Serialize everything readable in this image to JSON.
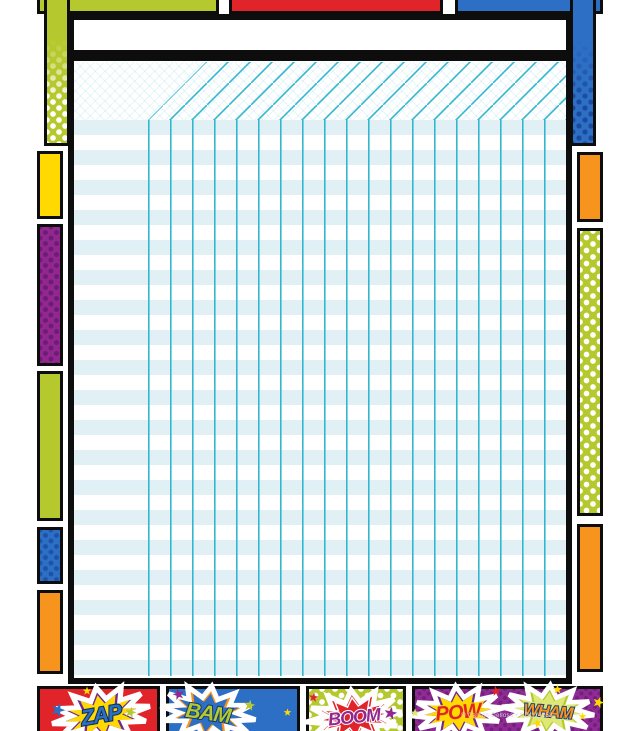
{
  "poster": {
    "type": "superhero-comic-incentive-chart",
    "title_writein": "",
    "grid": {
      "rows": 37,
      "columns": 19,
      "has_name_column": true,
      "line_color": "#33b6d0",
      "stripe_color": "#e1f0f5"
    },
    "burst_words": [
      "ZAP",
      "BAM",
      "BOOM",
      "POW",
      "WHAM"
    ],
    "copyright": "© Carson-Dellosa • CD-114253"
  },
  "palette": {
    "red": "#e1232a",
    "blue": "#2d6fc4",
    "lime": "#b5c92f",
    "yellow": "#ffd900",
    "orange": "#f7941e",
    "purple": "#92278f",
    "burst_purple": "#6e2a8e",
    "panel_purple": "#8e2b94",
    "pale_lime": "#dde877",
    "teal": "#33b6d0",
    "stripe_blue": "#e1f0f5",
    "navy": "#1d3e7a",
    "black": "#0d0d0d",
    "white": "#ffffff"
  }
}
